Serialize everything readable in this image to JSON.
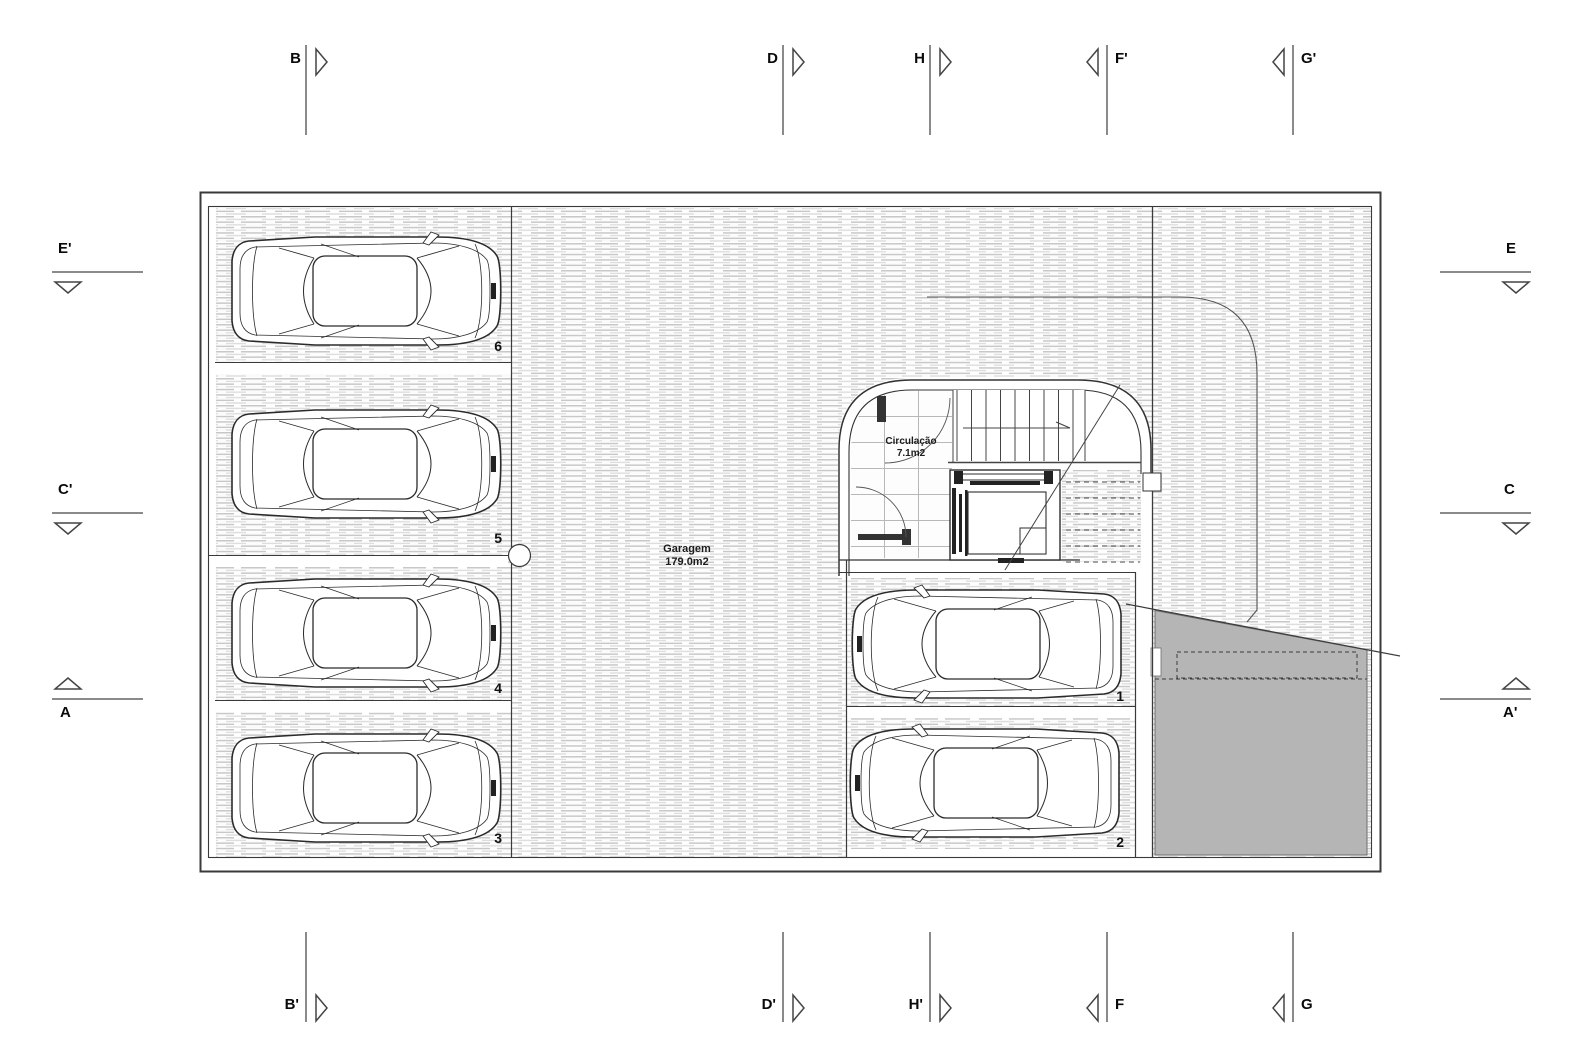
{
  "drawing": {
    "garage": {
      "name": "Garagem",
      "area": "179.0m2"
    },
    "circulation": {
      "name": "Circulação",
      "area": "7.1m2"
    },
    "stalls": {
      "s6": "6",
      "s5": "5",
      "s4": "4",
      "s3": "3",
      "s1": "1",
      "s2": "2"
    }
  },
  "section_markers": {
    "top": {
      "b": "B",
      "d": "D",
      "h": "H",
      "f2": "F'",
      "g2": "G'"
    },
    "bottom": {
      "b2": "B'",
      "d2": "D'",
      "h2": "H'",
      "f": "F",
      "g": "G"
    },
    "left": {
      "e2": "E'",
      "c2": "C'",
      "a": "A"
    },
    "right": {
      "e": "E",
      "c": "C",
      "a2": "A'"
    }
  },
  "colors": {
    "wall_line": "#3a3a3a",
    "hatch_line": "#c8c8c8",
    "ramp_fill": "#b5b5b5"
  }
}
